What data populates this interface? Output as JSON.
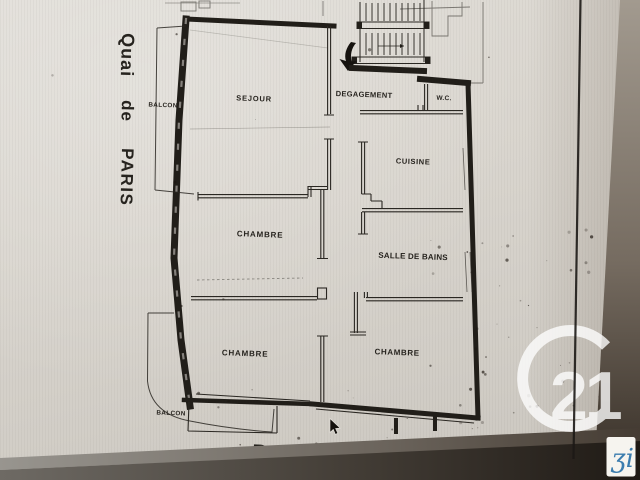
{
  "plan": {
    "rooms": {
      "sejour": "SEJOUR",
      "degagement": "DEGAGEMENT",
      "wc": "W.C.",
      "cuisine": "CUISINE",
      "chambre_center": "CHAMBRE",
      "salle_de_bains": "SALLE DE BAINS",
      "chambre_bottom_left": "CHAMBRE",
      "chambre_bottom_right": "CHAMBRE"
    },
    "balconies": {
      "top": "BALCON",
      "bottom": "BALCON"
    },
    "streets": {
      "left": {
        "word1": "Quai",
        "word2": "de",
        "word3": "PARIS"
      },
      "bottom": {
        "word1": "Rue",
        "word2": "A.",
        "word3": "CARREL"
      }
    }
  },
  "watermark": {
    "number": "21"
  },
  "corner_logo": {
    "glyph": "ʒi"
  },
  "colors": {
    "ink": "#211e19",
    "paper": "#d8d4cd",
    "watermark_white": "#ffffff",
    "logo_blue": "#3b7cae",
    "band_dark": "#27211c"
  }
}
